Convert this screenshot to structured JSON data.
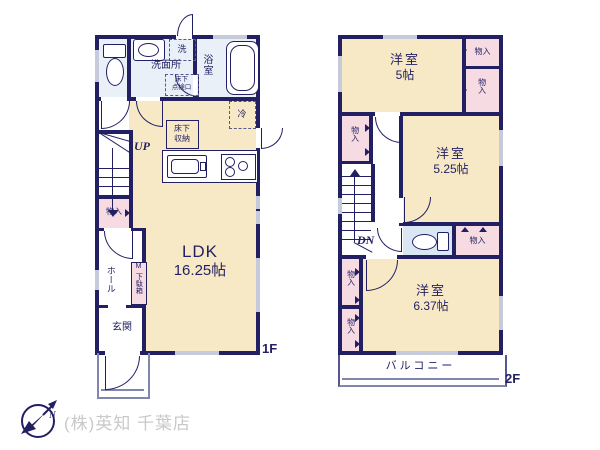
{
  "shared": {
    "closet": "物入"
  },
  "floor1": {
    "label": "1F",
    "ldk_name": "LDK",
    "ldk_size": "16.25帖",
    "washroom": "洗面所",
    "bath": "浴室",
    "entrance": "玄関",
    "hall": "ホール",
    "shoe_m": "M",
    "shoe_box": "下駄箱",
    "underfloor_storage_l1": "床下",
    "underfloor_storage_l2": "収納",
    "hatch_l1": "床下",
    "hatch_l2": "点検口",
    "washer": "洗",
    "fridge": "冷",
    "up": "UP"
  },
  "floor2": {
    "label": "2F",
    "bedroom1_name": "洋室",
    "bedroom1_size": "5帖",
    "bedroom2_name": "洋室",
    "bedroom2_size": "5.25帖",
    "bedroom3_name": "洋室",
    "bedroom3_size": "6.37帖",
    "balcony": "バルコニー",
    "dn": "DN"
  },
  "footer": {
    "company": "(株)英知 千葉店",
    "north": "N"
  },
  "colors": {
    "wall_navy": "#221f63",
    "room_cream": "#f7e9c6",
    "closet_pink": "#f6dbe2",
    "wet_room_blue": "#e9f0f8",
    "toilet_blue": "#d9e6f4",
    "window_gray": "#c6cbdc",
    "company_gray": "#c9c9c9"
  }
}
